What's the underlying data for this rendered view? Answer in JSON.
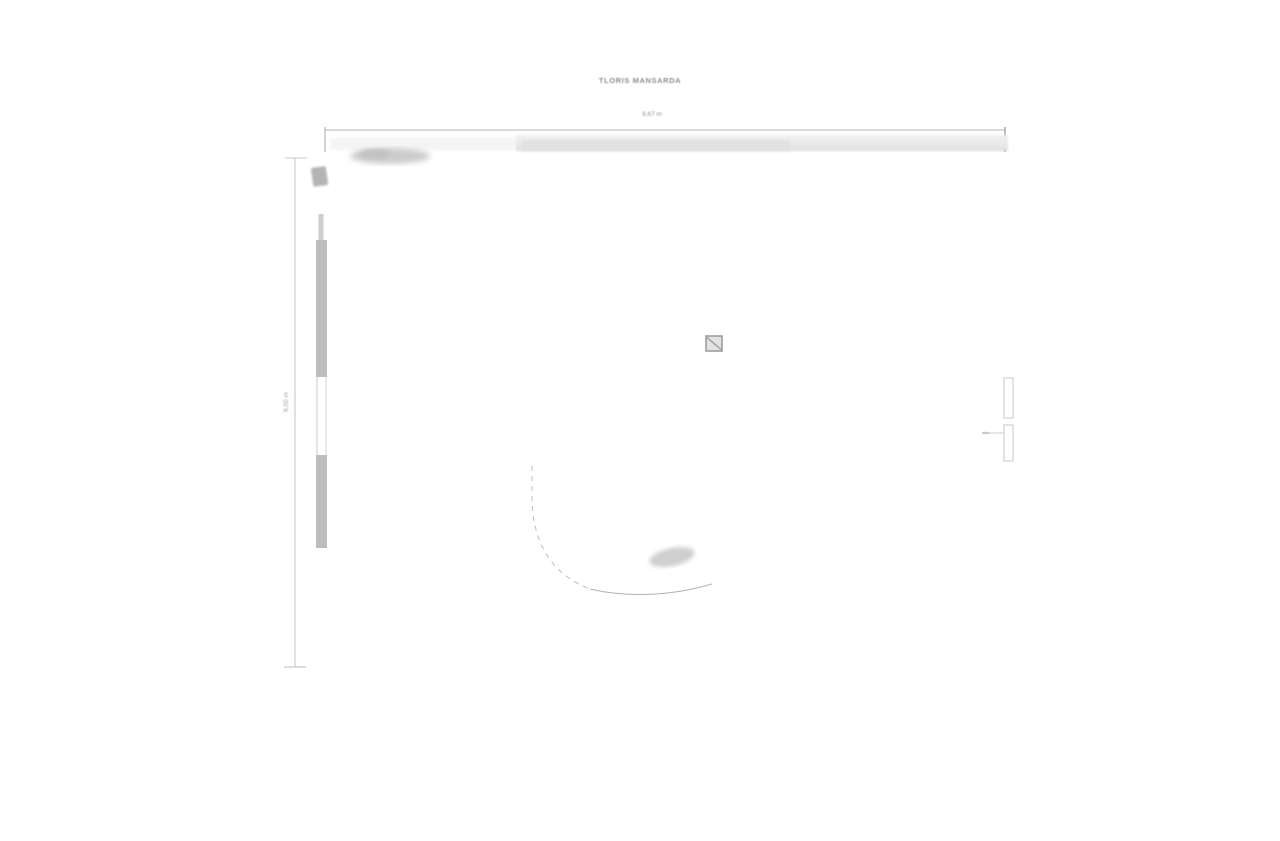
{
  "drawing": {
    "title": "TLORIS MANSARDA",
    "dimensions": {
      "width_label": "9,67 m",
      "height_label": "6,00 m"
    },
    "symbols": {
      "center_symbol": "chimney-square-with-diagonal",
      "left_wall": "wall-with-window-opening",
      "right_wall": "double-window-frames",
      "arc": "door-swing-arc"
    },
    "colors": {
      "background": "#ffffff",
      "dimension_line": "#b4b4b4",
      "wall_fill": "#bdbdbd",
      "faint_wall_band": "#e9e9e9",
      "title_text": "#8c8c8c",
      "symbol_stroke": "#9c9c9c"
    }
  }
}
